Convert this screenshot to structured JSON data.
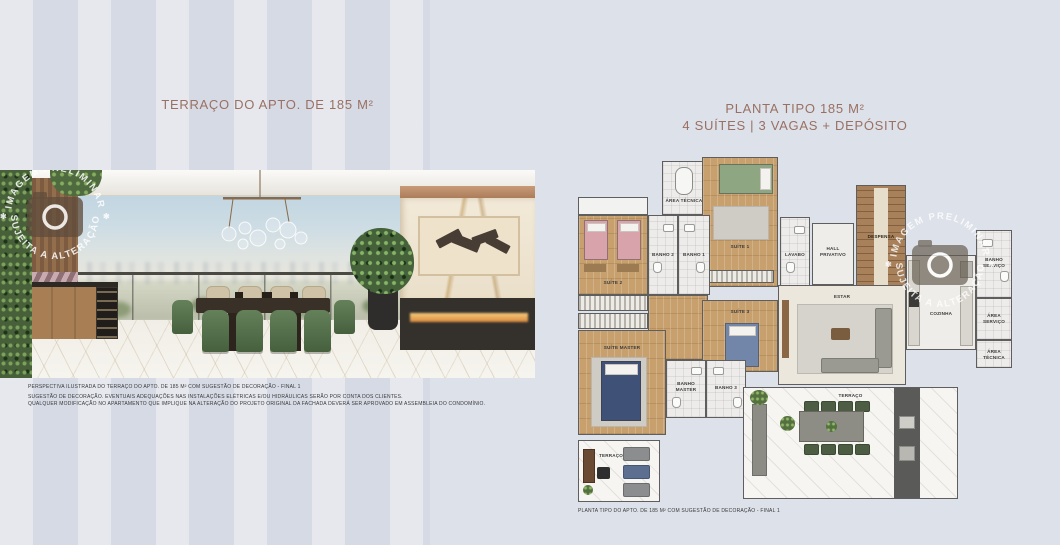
{
  "titles": {
    "left": "TERRAÇO DO APTO. DE 185 M²",
    "right_line1": "PLANTA TIPO 185 M²",
    "right_line2": "4 SUÍTES | 3 VAGAS + DEPÓSITO"
  },
  "captions": {
    "photo_line1": "PERSPECTIVA ILUSTRADA DO TERRAÇO DO APTO. DE 185 M² COM SUGESTÃO DE DECORAÇÃO - FINAL 1",
    "photo_line2": "SUGESTÃO DE DECORAÇÃO. EVENTUAIS ADEQUAÇÕES NAS INSTALAÇÕES ELÉTRICAS E/OU HIDRÁULICAS SERÃO POR CONTA DOS CLIENTES.",
    "photo_line3": "QUALQUER MODIFICAÇÃO NO APARTAMENTO QUE IMPLIQUE NA ALTERAÇÃO DO PROJETO ORIGINAL DA FACHADA DEVERÁ SER APROVADO EM ASSEMBLEIA DO CONDOMÍNIO.",
    "plan": "PLANTA TIPO DO APTO. DE 185 M² COM SUGESTÃO DE DECORAÇÃO - FINAL 1"
  },
  "watermark": {
    "arc_top": "IMAGEM PRELIMINAR",
    "arc_bottom": "SUJEITA A ALTERAÇÃO",
    "separator": "✱",
    "icon": "camera-icon"
  },
  "floorplan": {
    "rooms": [
      {
        "label": "ÁREA TÉCNICA"
      },
      {
        "label": "SUÍTE 1"
      },
      {
        "label": "BANHO 2"
      },
      {
        "label": "BANHO 1"
      },
      {
        "label": "SUÍTE 2"
      },
      {
        "label": "LAVABO"
      },
      {
        "label": "HALL PRIVATIVO"
      },
      {
        "label": "DESPENSA"
      },
      {
        "label": "BANHO SERVIÇO"
      },
      {
        "label": "COZINHA"
      },
      {
        "label": "ESTAR"
      },
      {
        "label": "SUÍTE 3"
      },
      {
        "label": "SUÍTE MASTER"
      },
      {
        "label": "BANHO MASTER"
      },
      {
        "label": "BANHO 3"
      },
      {
        "label": "TERRAÇO"
      },
      {
        "label": "TERRAÇO"
      },
      {
        "label": "ÁREA SERVIÇO"
      },
      {
        "label": "ÁREA TÉCNICA"
      }
    ]
  },
  "colors": {
    "page_bg": "#dde1e9",
    "title": "#9a7063",
    "caption": "#38383a",
    "plan_wall": "#5e5e5e",
    "accent_green": "#4e6a3e",
    "accent_pink": "#d9a3ab"
  }
}
